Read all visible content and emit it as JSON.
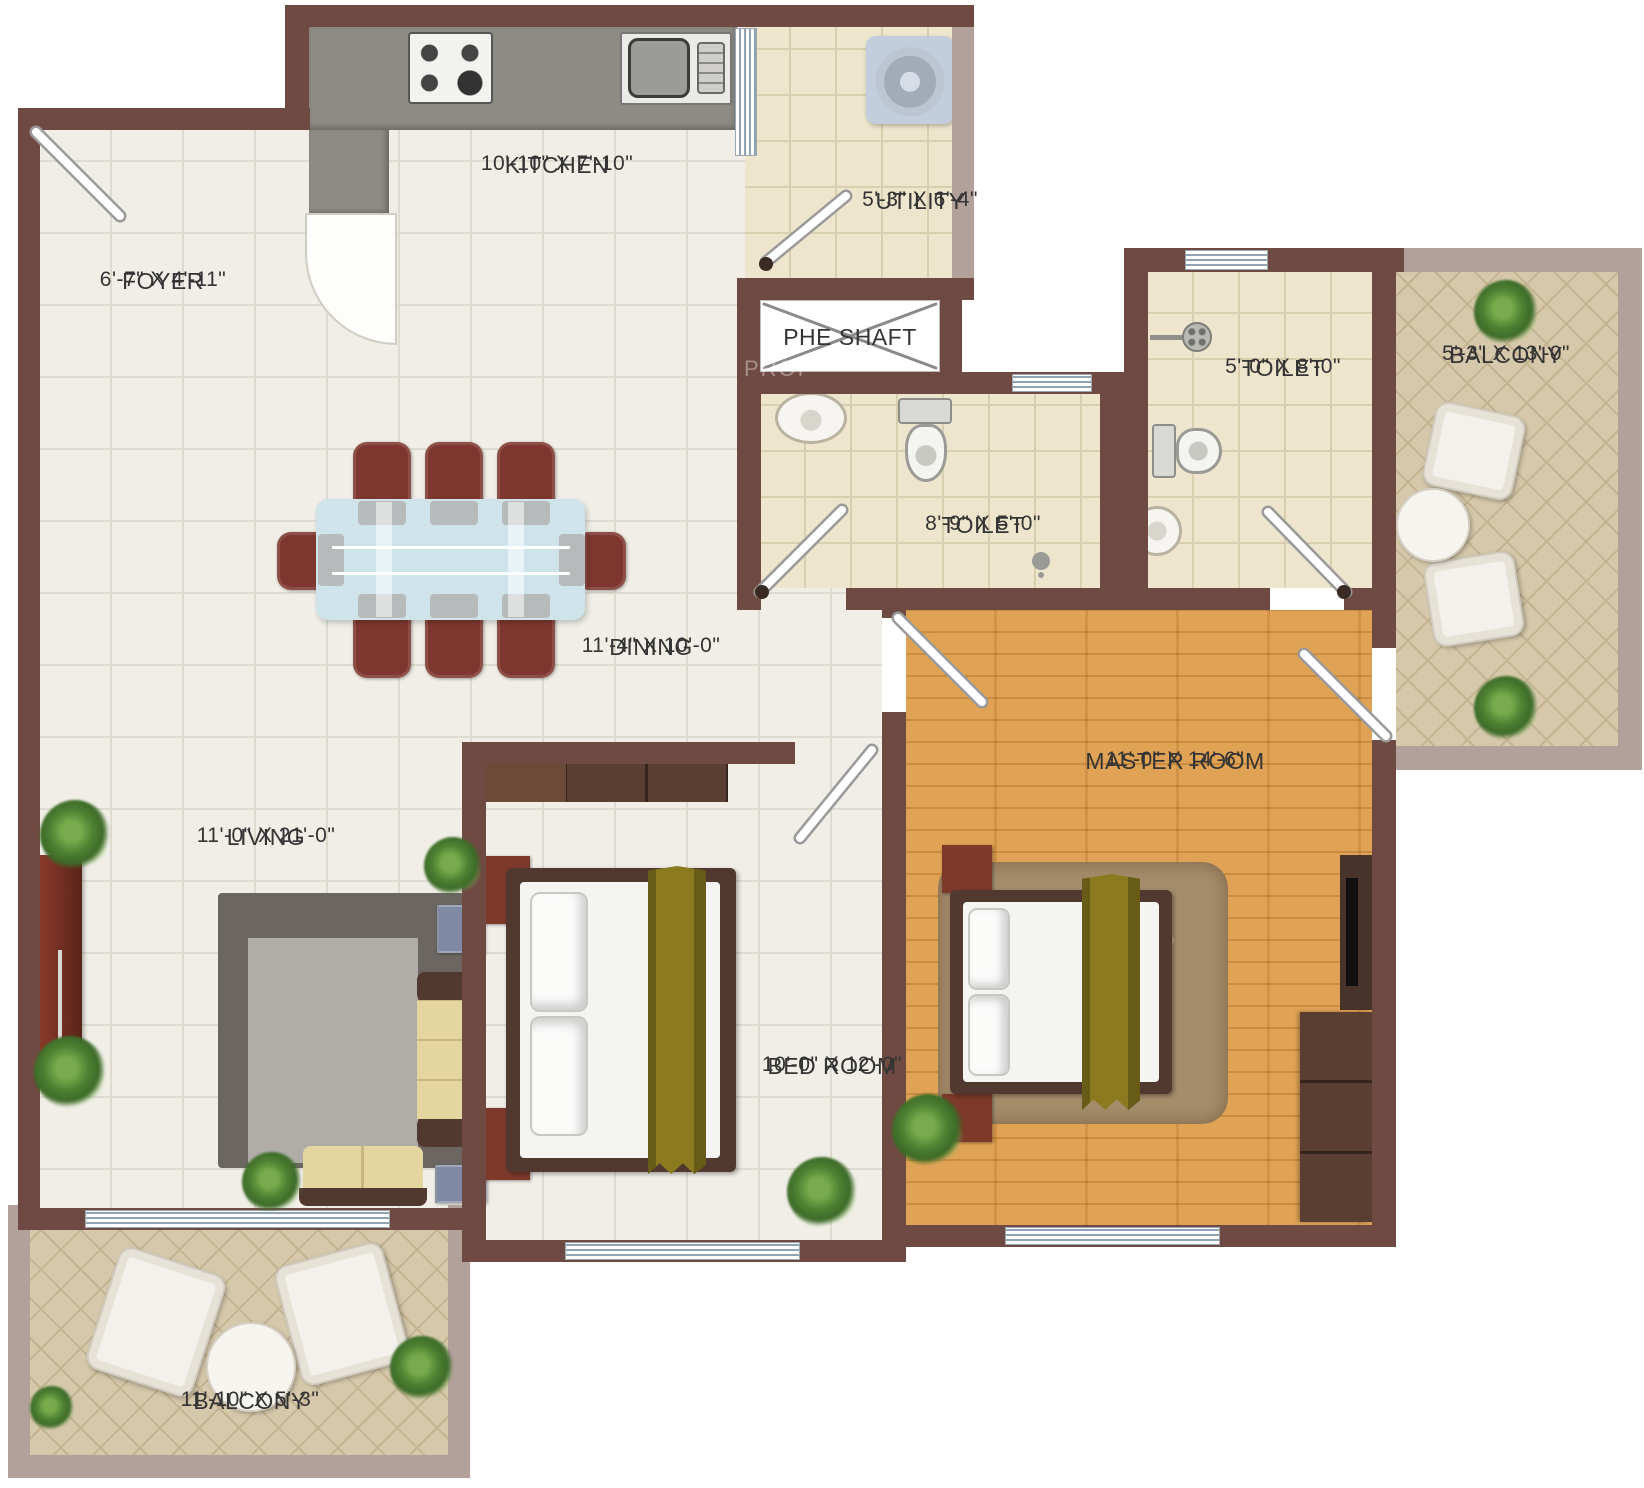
{
  "plan": {
    "rooms": {
      "kitchen": {
        "name": "KITCHEN",
        "dims": "10'-10\" X 7'-10\""
      },
      "utility": {
        "name": "UTILITY",
        "dims": "5'-3\" X 6'-4\""
      },
      "foyer": {
        "name": "FOYER",
        "dims": "6'-7\" X 4'-11\""
      },
      "phe_shaft": {
        "name": "PHE SHAFT",
        "dims": ""
      },
      "toilet_common": {
        "name": "TOILET",
        "dims": "8'-9\" X 5'-0\""
      },
      "toilet_master": {
        "name": "TOILET",
        "dims": "5'-0\" X 8'-0\""
      },
      "balcony_right": {
        "name": "BALCONY",
        "dims": "5'-3\" X 13'-0\""
      },
      "dining": {
        "name": "DINING",
        "dims": "11'-4\" X 10'-0\""
      },
      "living": {
        "name": "LIVING",
        "dims": "11'-0\" X 21'-0\""
      },
      "bedroom": {
        "name": "BED ROOM",
        "dims": "10'-0\" X 12'-0\""
      },
      "master": {
        "name": "MASTER ROOM",
        "dims": "11'-0\" X 14'-6\""
      },
      "balcony_bottom": {
        "name": "BALCONY",
        "dims": "11'-10\" X 5'-3\""
      }
    },
    "watermark": "PROP",
    "colors": {
      "wall": "#6F4A42",
      "outer_wall": "#B2A19A",
      "tile": "#F0EEE7",
      "bath_tile": "#EDE5CC",
      "balcony_tile": "#D6C9AB",
      "wood": "#E0A355",
      "counter": "#8E8B85",
      "chair": "#7E372E",
      "glass": "#CFE3EA",
      "sofa": "#E5D6A0",
      "runner": "#8B7A1F",
      "frame": "#523930",
      "nightstand": "#7D3A2B"
    }
  }
}
